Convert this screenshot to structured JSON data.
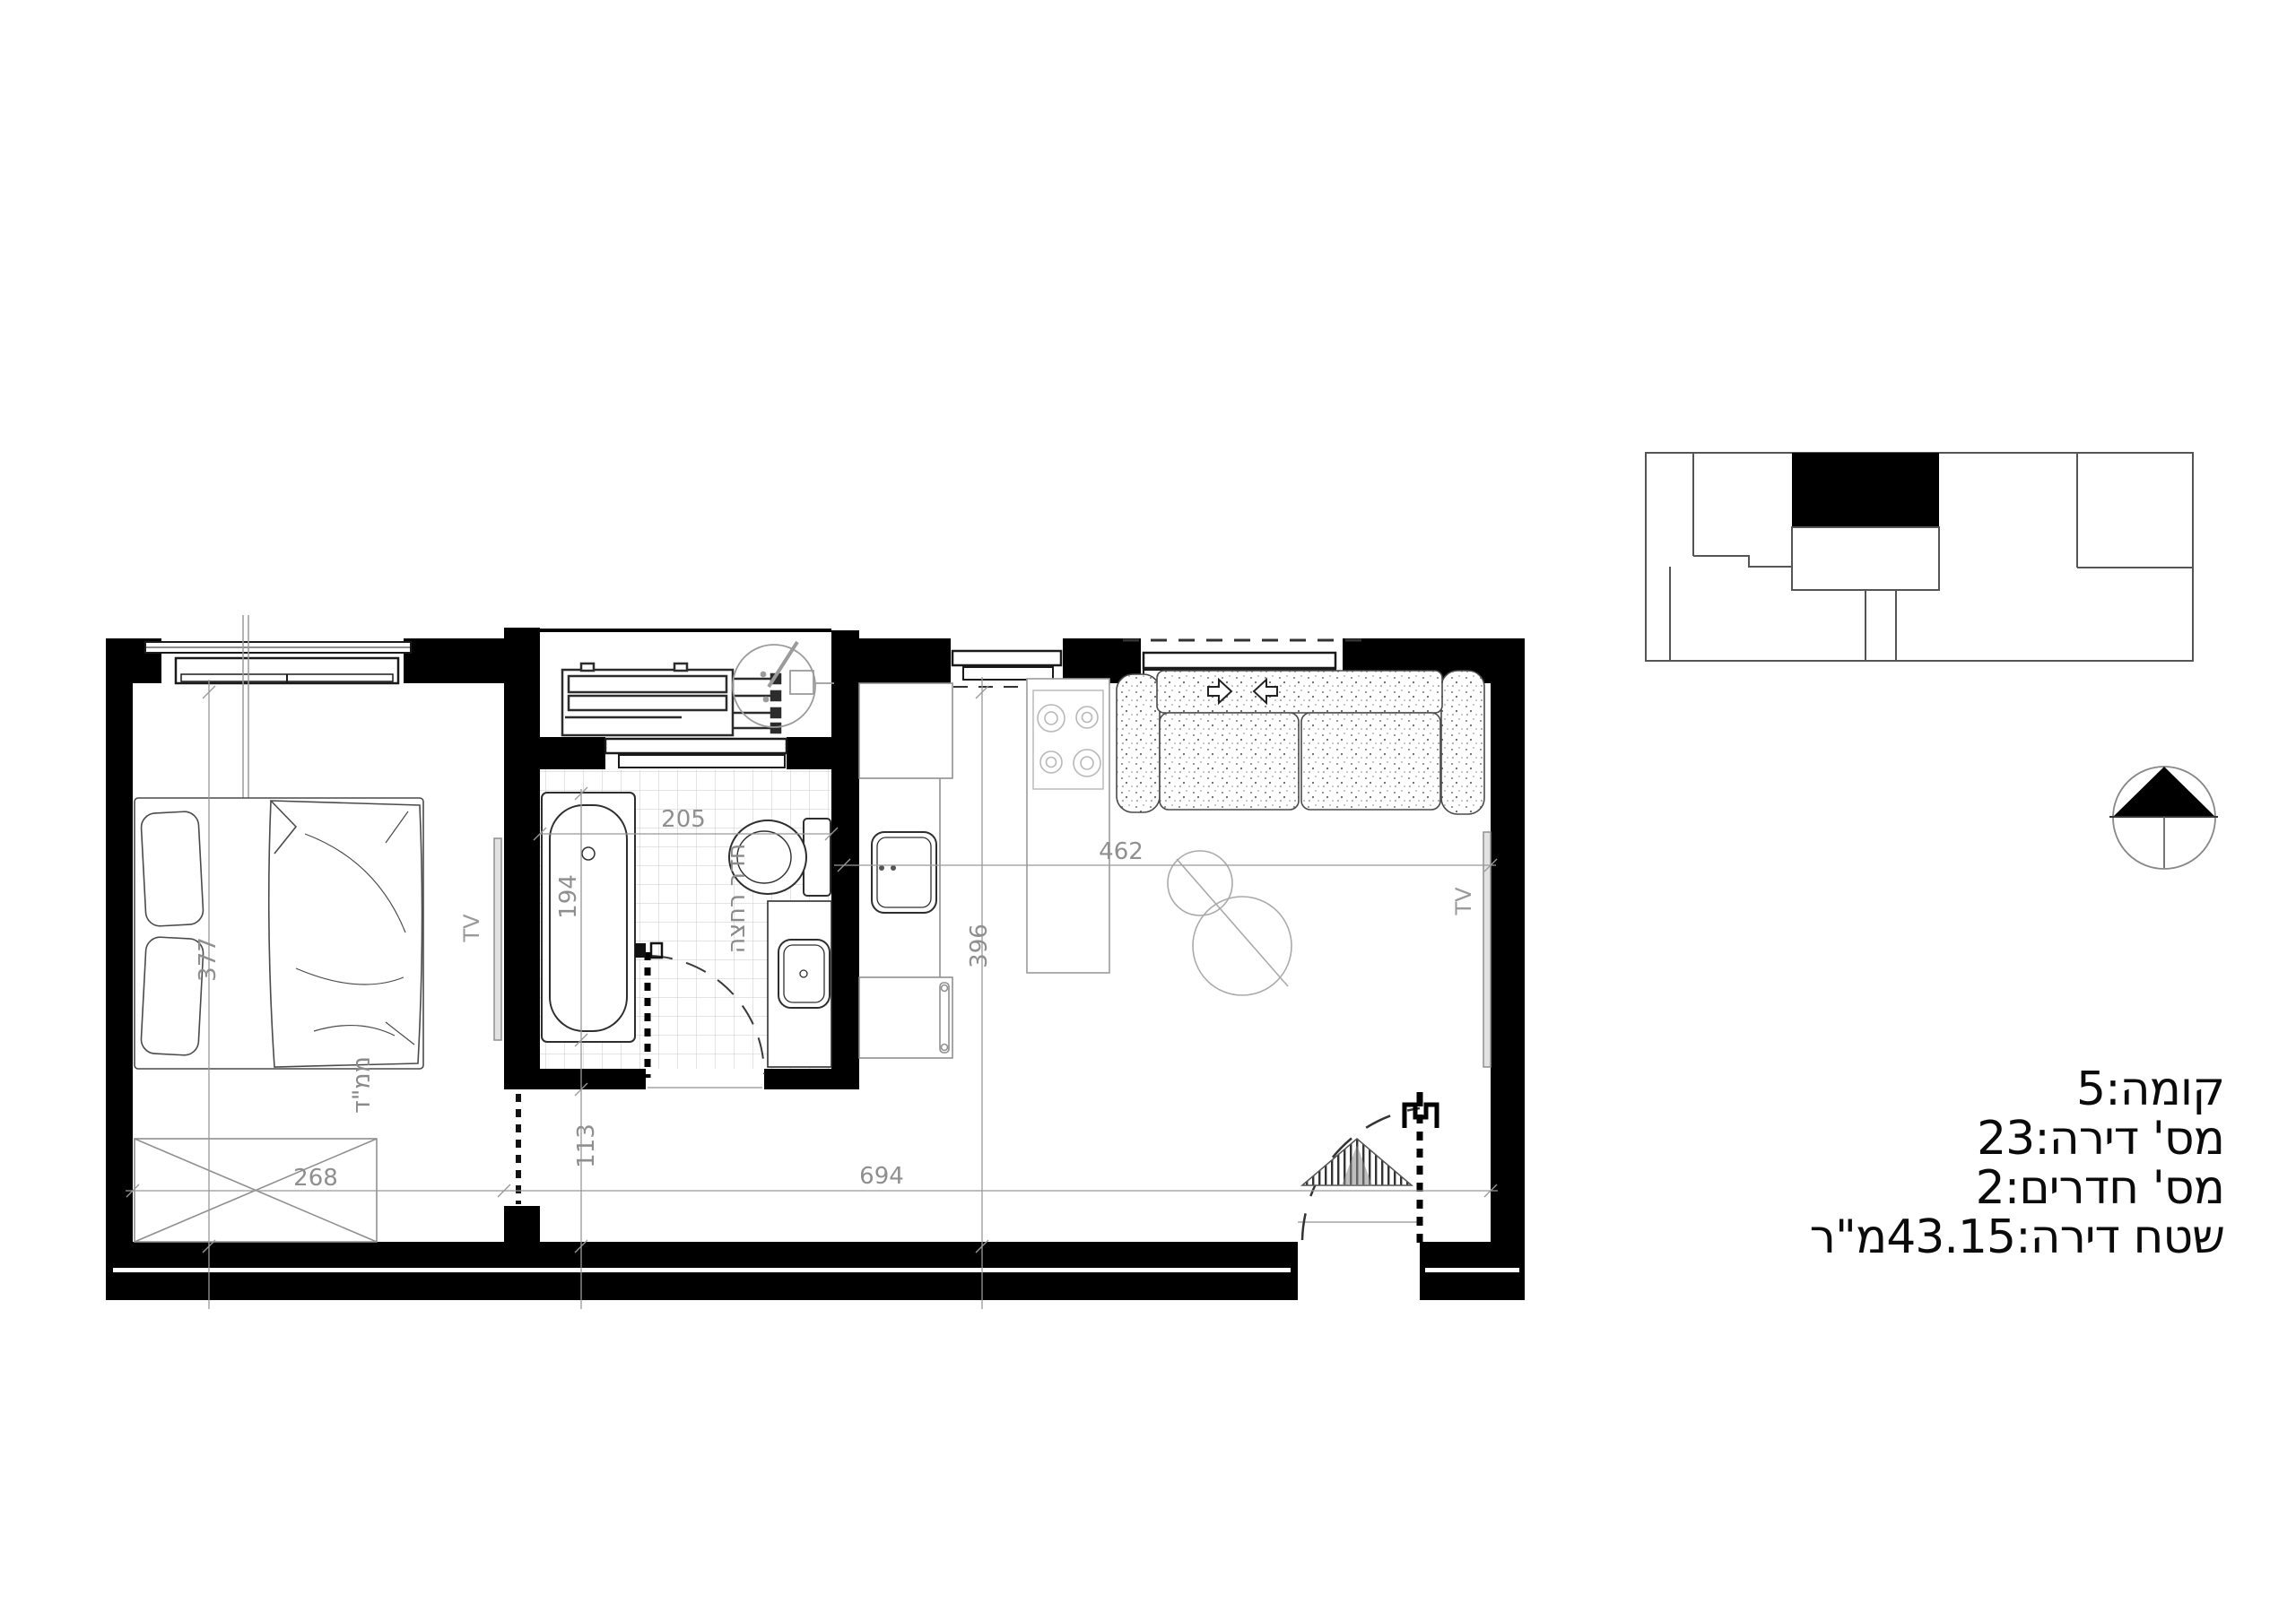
{
  "info_panel": {
    "floor_line": "קומה:5",
    "apartment_line": "מס' דירה:23",
    "rooms_line": "מס' חדרים:2",
    "area_line": "שטח דירה:43.15מ\"ר"
  },
  "plan": {
    "room_labels": {
      "bathroom": "חדר רחצה",
      "shelter": "ממ\"ד"
    },
    "tv_labels": {
      "bedroom": "TV",
      "living": "TV"
    },
    "dimensions": {
      "bedroom_length": "377",
      "bedroom_width": "268",
      "bathroom_width": "205",
      "bathtub_length": "194",
      "hallway_width": "113",
      "living_width": "462",
      "living_length": "396",
      "apartment_width": "694"
    }
  },
  "colors": {
    "walls": "#000000",
    "dim_lines": "#999999",
    "furniture": "#4a4a4a",
    "tiles": "#c9c9c9",
    "background": "#ffffff"
  }
}
